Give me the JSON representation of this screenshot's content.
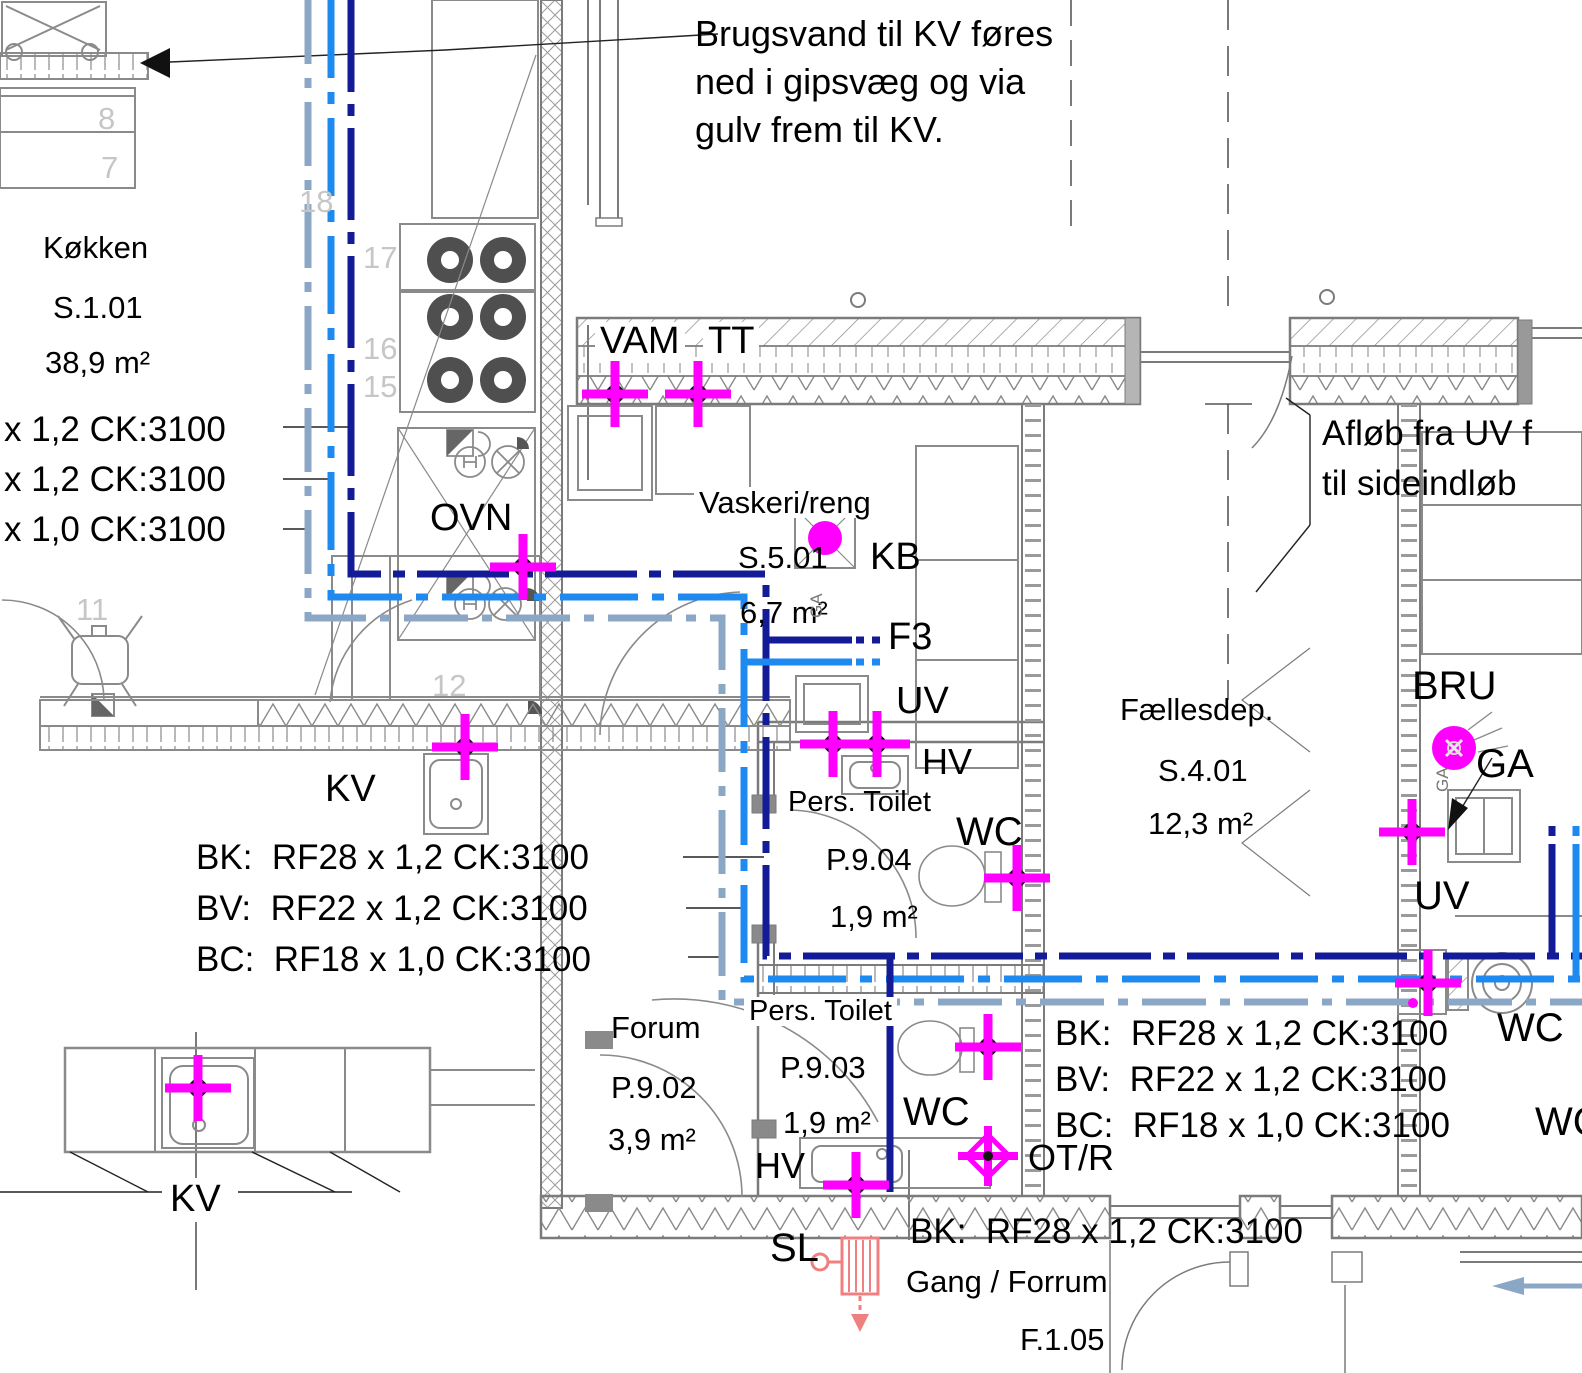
{
  "note": {
    "l1": "Brugsvand til KV føres",
    "l2": "ned i gipsvæg og via",
    "l3": "gulv frem til KV."
  },
  "rooms": {
    "koekken": {
      "name": "Køkken",
      "code": "S.1.01",
      "area": "38,9 m²"
    },
    "vaskeri": {
      "name": "Vaskeri/reng",
      "code": "S.5.01",
      "area": "6,7 m²"
    },
    "pt904": {
      "name": "Pers. Toilet",
      "code": "P.9.04",
      "area": "1,9 m²"
    },
    "faellesdep": {
      "name": "Fællesdep.",
      "code": "S.4.01",
      "area": "12,3 m²"
    },
    "forum": {
      "name": "Forum",
      "code": "P.9.02",
      "area": "3,9 m²"
    },
    "pt903": {
      "name": "Pers. Toilet",
      "code": "P.9.03",
      "area": "1,9 m²"
    },
    "gang": {
      "name": "Gang / Forrum",
      "code": "F.1.05"
    }
  },
  "pipe_specs": {
    "left_truncated": [
      "x 1,2 CK:3100",
      "x 1,2 CK:3100",
      "x 1,0 CK:3100"
    ],
    "left_block": {
      "bk": "BK:  RF28 x 1,2 CK:3100",
      "bv": "BV:  RF22 x 1,2 CK:3100",
      "bc": "BC:  RF18 x 1,0 CK:3100"
    },
    "right_block": {
      "bk": "BK:  RF28 x 1,2 CK:3100",
      "bv": "BV:  RF22 x 1,2 CK:3100",
      "bc": "BC:  RF18 x 1,0 CK:3100"
    },
    "bottom": "BK:  RF28 x 1,2 CK:3100"
  },
  "annotations": {
    "afloeb1": "Afløb fra UV f",
    "afloeb2": "til sideindløb"
  },
  "tags": {
    "vam": "VAM",
    "tt": "TT",
    "ovn": "OVN",
    "kb": "KB",
    "f3": "F3",
    "uv_vaskeri": "UV",
    "hv_904": "HV",
    "wc_904": "WC",
    "bru": "BRU",
    "ga": "GA",
    "uv_bru": "UV",
    "kv_top": "KV",
    "kv_bottom": "KV",
    "wc_903": "WC",
    "hv_903": "HV",
    "otr": "OT/R",
    "sl": "SL",
    "wc_right": "WC",
    "wc_right_partial": "WC",
    "ga_drain": "GA"
  },
  "ref_numbers": {
    "n8": "8",
    "n7": "7",
    "n18": "18",
    "n17": "17",
    "n16": "16",
    "n15": "15",
    "n11": "11",
    "n12": "12"
  },
  "colors": {
    "pipe_bk_navy": "#141b96",
    "pipe_bv_blue": "#1e8af0",
    "pipe_bc_steel": "#8ba7c6",
    "valve_magenta": "#ff00ff",
    "radiator_red": "#f08080",
    "wall_grey": "#7b7b7b",
    "ref_grey": "#c6c6c6"
  }
}
